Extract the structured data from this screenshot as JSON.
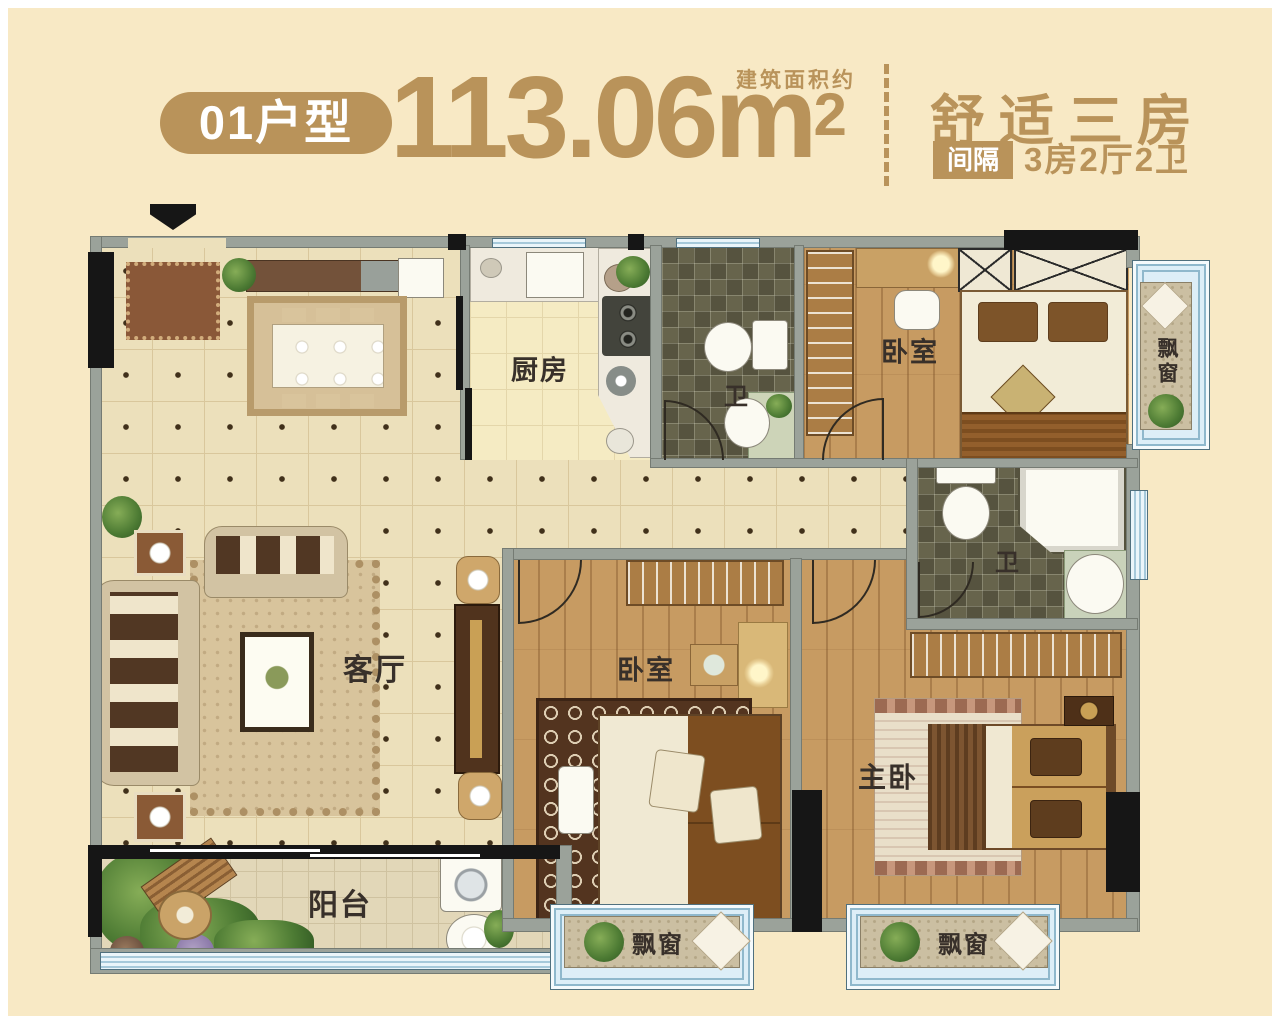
{
  "header": {
    "unit_badge": "01户型",
    "area_note": "建筑面积约",
    "area_value": "113.06m",
    "area_sup": "2",
    "title": "舒适三房",
    "layout_badge": "间隔",
    "layout_text": "3房2厅2卫"
  },
  "rooms": {
    "kitchen": "厨房",
    "bath_top": "卫",
    "bedroom_top": "卧室",
    "bay_right": "飘窗",
    "bath_mid": "卫",
    "living": "客厅",
    "bedroom_mid": "卧室",
    "master": "主卧",
    "balcony": "阳台",
    "bay_bottom_left": "飘窗",
    "bay_bottom_right": "飘窗"
  },
  "colors": {
    "accent_gold": "#b9935a",
    "background_cream": "#f8e9c5",
    "wall_gray": "#9ba29a",
    "window_blue": "#cfe7f3",
    "wood_floor": "#c79b62",
    "bath_tile": "#5e5b45"
  }
}
